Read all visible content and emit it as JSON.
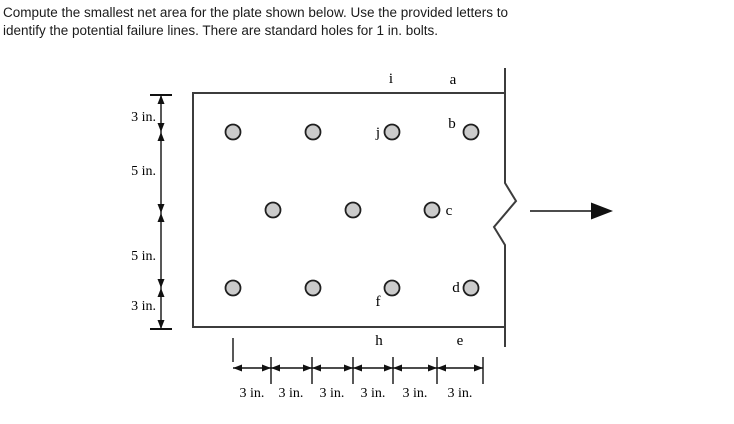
{
  "problem": {
    "line1": "Compute the smallest net area for the plate shown below. Use the provided letters to",
    "line2": "identify the potential failure lines. There are standard holes for 1 in. bolts."
  },
  "colors": {
    "background": "#ffffff",
    "plate_line": "#3c3c3c",
    "dim_line": "#111111",
    "hole_fill": "#cbcbcb",
    "hole_stroke": "#1f1f1f",
    "text": "#000000"
  },
  "diagram": {
    "plate": {
      "left": 193,
      "top": 93,
      "right": 505,
      "bottom": 327,
      "right_edge_top_ext": 68,
      "right_edge_bottom_ext": 347,
      "break_points": [
        [
          505,
          183
        ],
        [
          516,
          201
        ],
        [
          494,
          227
        ],
        [
          505,
          245
        ]
      ]
    },
    "holes": {
      "radius": 7.5,
      "rows": [
        {
          "y": 132,
          "xs": [
            233,
            313,
            392,
            471
          ]
        },
        {
          "y": 210,
          "xs": [
            273,
            353,
            432
          ]
        },
        {
          "y": 288,
          "xs": [
            233,
            313,
            392,
            471
          ]
        }
      ]
    },
    "failure_point_labels": [
      {
        "text": "i",
        "x": 391,
        "y": 83
      },
      {
        "text": "a",
        "x": 453,
        "y": 84
      },
      {
        "text": "j",
        "x": 378,
        "y": 137
      },
      {
        "text": "b",
        "x": 452,
        "y": 128
      },
      {
        "text": "c",
        "x": 449,
        "y": 215
      },
      {
        "text": "f",
        "x": 378,
        "y": 306
      },
      {
        "text": "d",
        "x": 456,
        "y": 292
      },
      {
        "text": "h",
        "x": 379,
        "y": 345
      },
      {
        "text": "e",
        "x": 460,
        "y": 345
      }
    ],
    "force_arrow": {
      "x1": 530,
      "y": 211,
      "tip_x": 613,
      "head_len": 22,
      "head_half": 8.5
    },
    "left_dimension": {
      "x": 161,
      "top": 95,
      "bottom": 329,
      "end_bar_half": 11,
      "joints": [
        132,
        213,
        288
      ],
      "labels": [
        {
          "text": "3 in.",
          "x": 156,
          "y": 121
        },
        {
          "text": "5 in.",
          "x": 156,
          "y": 175
        },
        {
          "text": "5 in.",
          "x": 156,
          "y": 260
        },
        {
          "text": "3 in.",
          "x": 156,
          "y": 310
        }
      ]
    },
    "bottom_dimension": {
      "y": 368,
      "start": 233,
      "end": 483,
      "start_tick": {
        "x": 233,
        "y1": 338,
        "y2": 362
      },
      "ticks": [
        271,
        312,
        353,
        393,
        437,
        483
      ],
      "tick_y1": 357,
      "tick_y2": 384,
      "label_y": 397,
      "labels": [
        {
          "text": "3 in.",
          "x": 252
        },
        {
          "text": "3 in.",
          "x": 291
        },
        {
          "text": "3 in.",
          "x": 332
        },
        {
          "text": "3 in.",
          "x": 373
        },
        {
          "text": "3 in.",
          "x": 415
        },
        {
          "text": "3 in.",
          "x": 460
        }
      ]
    }
  }
}
